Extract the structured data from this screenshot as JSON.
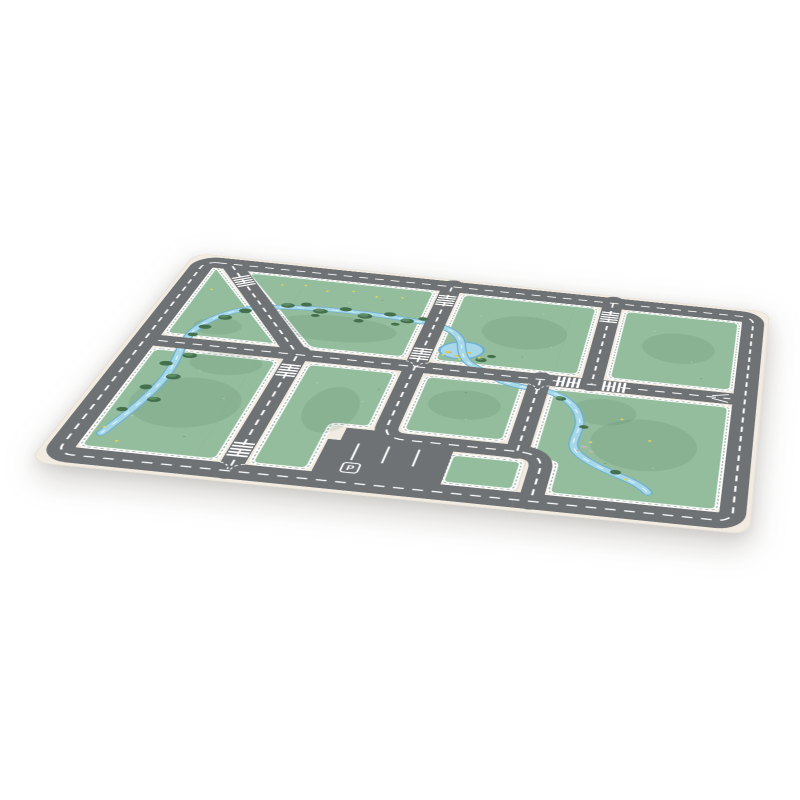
{
  "image": {
    "kind": "product-photo",
    "subject": "children's roadway play mat viewed in perspective",
    "background_color": "#ffffff"
  },
  "colors": {
    "mat_edge": "#f1ebe1",
    "road": "#6f7275",
    "marking": "#ffffff",
    "grass": "#94bd9e",
    "block_border": "#ffffff",
    "fringe": "rgba(60,98,70,0.45)",
    "tree_dark": "#44704e",
    "tree_light": "#5d8d66",
    "river_edge": "#6fb0cf",
    "river_fill": "#a6d8ea",
    "river_line": "#eaf7fc",
    "flower": "#ead34f",
    "duck": "#eac63d",
    "duck_beak": "#d98a2b",
    "rock": "#b5bab3",
    "seam": "#9a9a98",
    "mottle": "rgba(45,85,55,0.10)"
  },
  "mat": {
    "parking": {
      "label": "P",
      "space_count": 4,
      "divider_count": 3
    },
    "block_count": 8,
    "zebra_crossing_count": 8,
    "duck_count": 3,
    "features": [
      "perimeter road",
      "dashed center lines",
      "diagonal road",
      "river",
      "pond with ducks",
      "trees",
      "flowers",
      "parking lot",
      "zebra crossings",
      "rocks",
      "tile seams"
    ]
  }
}
